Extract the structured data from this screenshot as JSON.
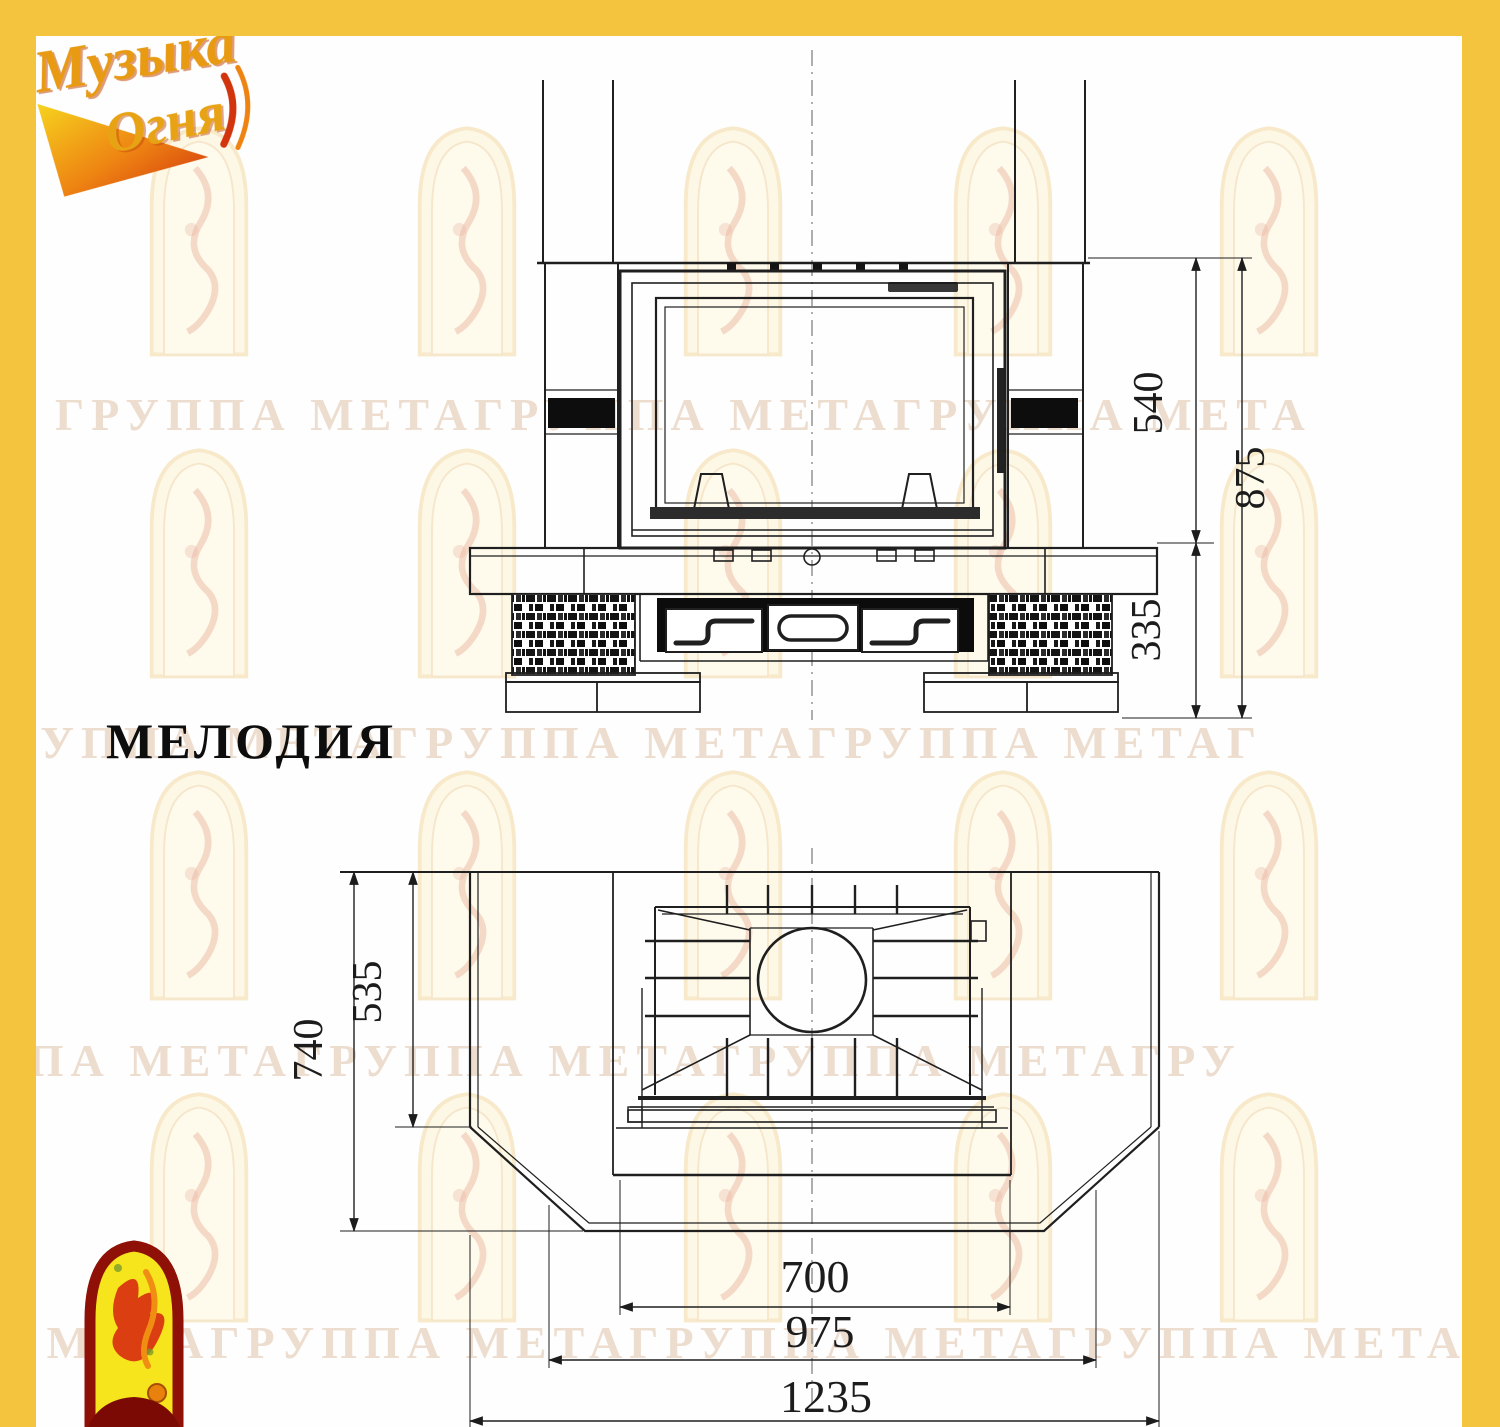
{
  "page": {
    "background": "#ffffff",
    "border_color": "#f5c43e"
  },
  "logo": {
    "line1": "Музыка",
    "line2": "Огня"
  },
  "model_title": "МЕЛОДИЯ",
  "watermark_rows": [
    "ГРУППА МЕТАГРУППА МЕТАГРУППА МЕТА",
    "ГРУППА МЕТАГРУППА МЕТАГРУППА МЕТАГ",
    "ППА МЕТАГРУППА МЕТАГРУППА МЕТАГРУ",
    "ПА МЕТАГРУППА МЕТАГРУППА МЕТАГРУППА МЕТА"
  ],
  "front_view": {
    "dim_firebox_height": "540",
    "dim_total_height": "875",
    "dim_base_height": "335"
  },
  "plan_view": {
    "dim_total_depth": "740",
    "dim_inner_depth": "535",
    "dim_opening_width": "700",
    "dim_mid_width": "975",
    "dim_total_width": "1235"
  }
}
